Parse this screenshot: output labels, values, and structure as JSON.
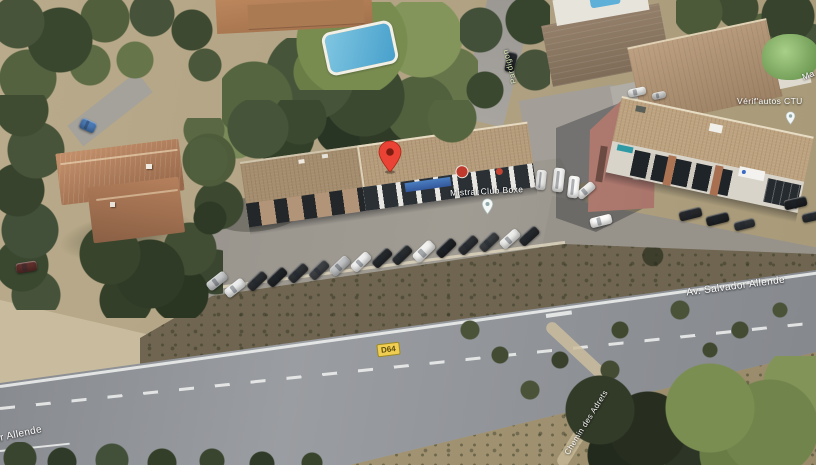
{
  "view": {
    "type": "satellite-aerial-map"
  },
  "labels": {
    "road_main": "Av. Salvador Allende",
    "road_partial": "or Allende",
    "route_badge": "D64",
    "place_center": "Mistral Club Boxe",
    "place_right": "Vérif'autos CTU",
    "path": "Chemin des Adrets",
    "lane": "Pardigon",
    "edge_partial": "Ma"
  },
  "colors": {
    "pin": "#EA4335",
    "pin_inner": "#7D1D12",
    "badge_bg": "#F0CE52",
    "badge_border": "#9C8A26",
    "badge_text": "#5C4D0E",
    "label_text": "#FFFFFF",
    "lane_label_text": "#D6E6B4"
  },
  "markers": [
    {
      "name": "dropped-pin",
      "kind": "red-pin"
    },
    {
      "name": "place-center-pin",
      "kind": "white-pin"
    },
    {
      "name": "place-right-pin",
      "kind": "white-pin"
    }
  ],
  "vehicles": [
    {
      "x": 206,
      "y": 276,
      "w": 22,
      "h": 10,
      "r": -38,
      "c": "#c9cbcc"
    },
    {
      "x": 224,
      "y": 283,
      "w": 22,
      "h": 10,
      "r": -38,
      "c": "#eceded"
    },
    {
      "x": 246,
      "y": 276,
      "w": 22,
      "h": 10,
      "r": -44,
      "c": "#2b2e31"
    },
    {
      "x": 266,
      "y": 272,
      "w": 22,
      "h": 10,
      "r": -44,
      "c": "#202326"
    },
    {
      "x": 287,
      "y": 268,
      "w": 22,
      "h": 10,
      "r": -44,
      "c": "#2e3134"
    },
    {
      "x": 308,
      "y": 265,
      "w": 22,
      "h": 10,
      "r": -44,
      "c": "#3e4144"
    },
    {
      "x": 329,
      "y": 261,
      "w": 22,
      "h": 10,
      "r": -44,
      "c": "#c2c4c6"
    },
    {
      "x": 350,
      "y": 257,
      "w": 22,
      "h": 10,
      "r": -44,
      "c": "#eff0ef"
    },
    {
      "x": 371,
      "y": 253,
      "w": 22,
      "h": 10,
      "r": -44,
      "c": "#25282b"
    },
    {
      "x": 391,
      "y": 250,
      "w": 22,
      "h": 10,
      "r": -44,
      "c": "#2a2d30"
    },
    {
      "x": 412,
      "y": 246,
      "w": 24,
      "h": 11,
      "r": -44,
      "c": "#f1f1ef"
    },
    {
      "x": 435,
      "y": 243,
      "w": 22,
      "h": 10,
      "r": -44,
      "c": "#1f2225"
    },
    {
      "x": 457,
      "y": 240,
      "w": 22,
      "h": 10,
      "r": -44,
      "c": "#2c2f32"
    },
    {
      "x": 478,
      "y": 237,
      "w": 22,
      "h": 10,
      "r": -44,
      "c": "#3a3d40"
    },
    {
      "x": 499,
      "y": 234,
      "w": 22,
      "h": 10,
      "r": -42,
      "c": "#edeeec"
    },
    {
      "x": 518,
      "y": 231,
      "w": 22,
      "h": 10,
      "r": -42,
      "c": "#26292c"
    },
    {
      "x": 576,
      "y": 186,
      "w": 20,
      "h": 9,
      "r": -40,
      "c": "#f1f1ef"
    },
    {
      "x": 590,
      "y": 216,
      "w": 22,
      "h": 10,
      "r": -14,
      "c": "#fdfdfc"
    },
    {
      "x": 679,
      "y": 209,
      "w": 23,
      "h": 10,
      "r": -14,
      "c": "#26282b"
    },
    {
      "x": 706,
      "y": 214,
      "w": 23,
      "h": 10,
      "r": -14,
      "c": "#1f2225"
    },
    {
      "x": 734,
      "y": 220,
      "w": 21,
      "h": 9,
      "r": -14,
      "c": "#2e3134"
    },
    {
      "x": 784,
      "y": 198,
      "w": 23,
      "h": 10,
      "r": -13,
      "c": "#1d2023"
    },
    {
      "x": 802,
      "y": 212,
      "w": 20,
      "h": 9,
      "r": -13,
      "c": "#292c2f"
    },
    {
      "x": 553,
      "y": 168,
      "w": 11,
      "h": 24,
      "r": 6,
      "c": "#f3f3f1"
    },
    {
      "x": 568,
      "y": 176,
      "w": 11,
      "h": 22,
      "r": 6,
      "c": "#fbfbfa"
    },
    {
      "x": 536,
      "y": 170,
      "w": 10,
      "h": 20,
      "r": 6,
      "c": "#e8e8e6"
    },
    {
      "x": 628,
      "y": 88,
      "w": 18,
      "h": 8,
      "r": -12,
      "c": "#eeeeec"
    },
    {
      "x": 652,
      "y": 92,
      "w": 14,
      "h": 7,
      "r": -12,
      "c": "#d6d6d4"
    },
    {
      "x": 16,
      "y": 262,
      "w": 21,
      "h": 10,
      "r": -9,
      "c": "#5e2f2b"
    },
    {
      "x": 80,
      "y": 120,
      "w": 16,
      "h": 11,
      "r": 24,
      "c": "#4a79b4"
    },
    {
      "x": 506,
      "y": 52,
      "w": 10,
      "h": 20,
      "r": 12,
      "c": "#24272a"
    }
  ]
}
